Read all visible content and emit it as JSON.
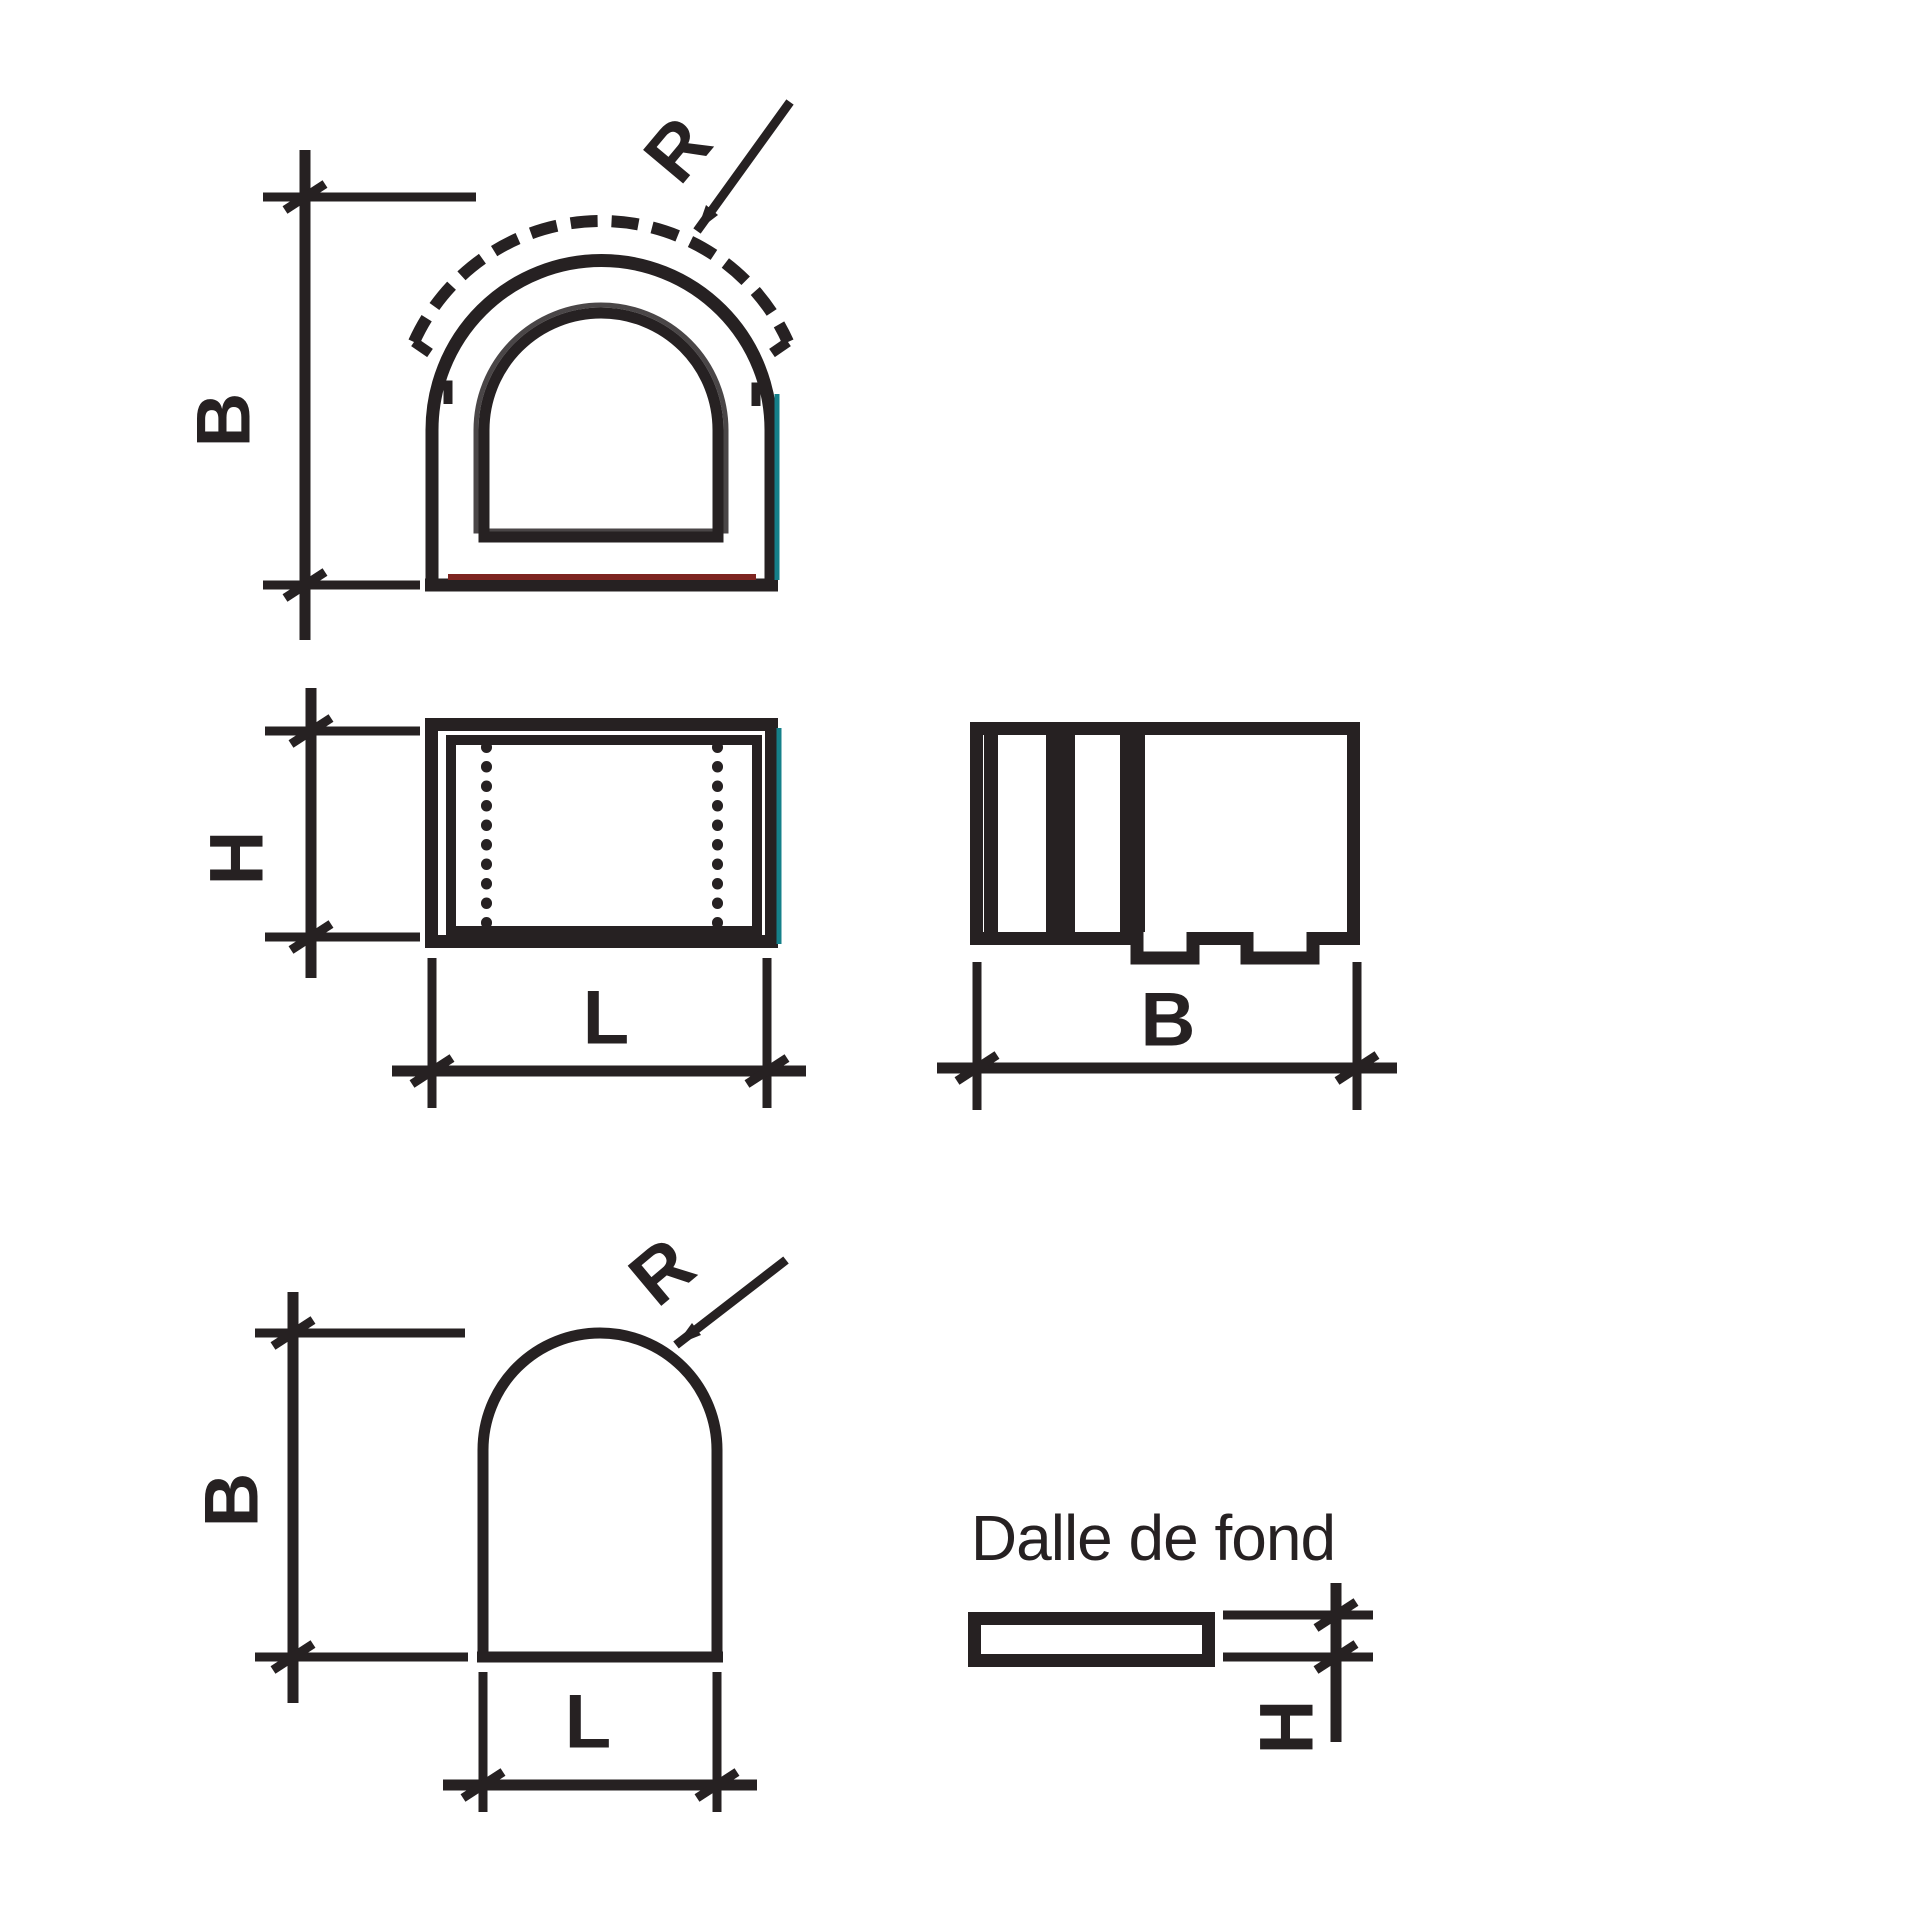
{
  "colors": {
    "ink": "#262122",
    "paper": "#ffffff",
    "accent_red": "#7d2420",
    "accent_teal": "#15808a"
  },
  "figures": {
    "front_view": {
      "dim_height_label": "B",
      "radius_label": "R"
    },
    "side_view": {
      "dim_height_label": "H",
      "dim_length_label": "L"
    },
    "end_view": {
      "dim_width_label": "B"
    },
    "opening_profile": {
      "dim_height_label": "B",
      "radius_label": "R",
      "dim_length_label": "L"
    },
    "bottom_slab": {
      "title": "Dalle de fond",
      "dim_thickness_label": "H"
    }
  }
}
